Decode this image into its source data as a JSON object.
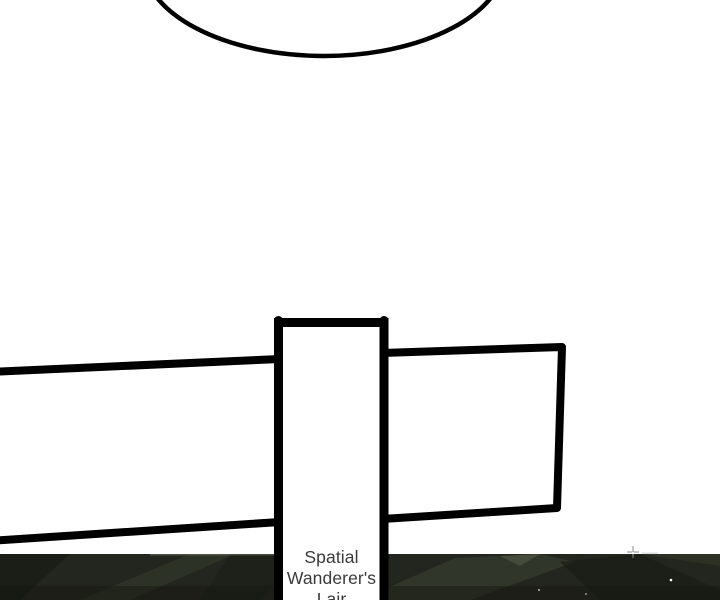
{
  "panel": {
    "background_color": "#ffffff",
    "ink_color": "#000000"
  },
  "speech_bubble": {
    "content": ""
  },
  "signpost": {
    "label": "Spatial Wanderer's Lair",
    "label_color": "#3a3a3a",
    "board_fill": "#ffffff",
    "outline_color": "#000000"
  },
  "night_landscape": {
    "base_color": "#23261e",
    "highlight_color": "#3f4536",
    "shadow_color": "#14160f",
    "star_color": "#ffffff"
  }
}
